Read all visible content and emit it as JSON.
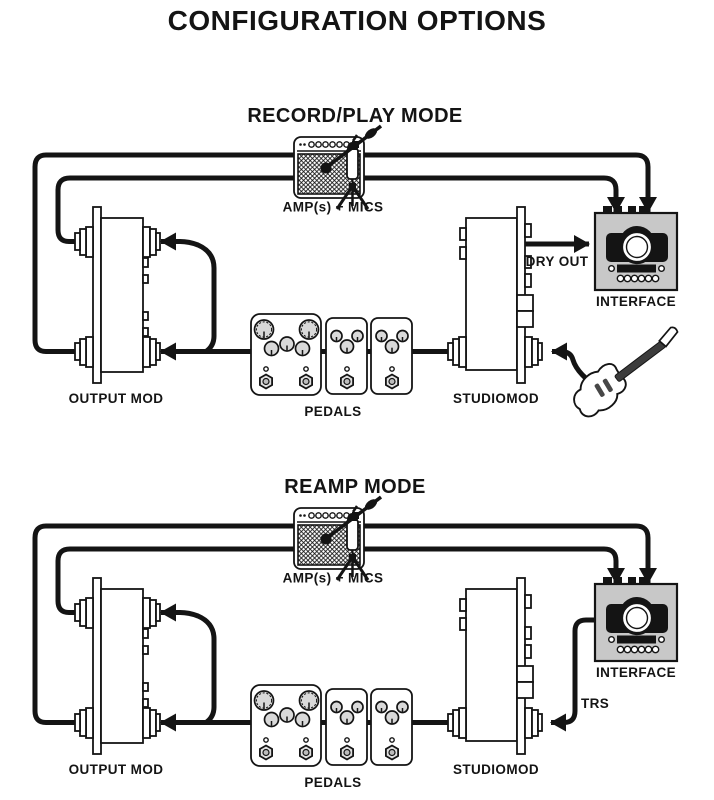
{
  "page_title": "CONFIGURATION OPTIONS",
  "colors": {
    "ink": "#141414",
    "interface_gray": "#c8c8c8",
    "knob_gray": "#d9d9d9",
    "background": "#ffffff"
  },
  "modes": [
    {
      "title": "RECORD/PLAY MODE",
      "amp_mics_label": "AMP(s) + MICS",
      "output_mod_label": "OUTPUT MOD",
      "pedals_label": "PEDALS",
      "studiomod_label": "STUDIOMOD",
      "interface_label": "INTERFACE",
      "dry_out_label": "DRY OUT"
    },
    {
      "title": "REAMP MODE",
      "amp_mics_label": "AMP(s) + MICS",
      "output_mod_label": "OUTPUT MOD",
      "pedals_label": "PEDALS",
      "studiomod_label": "STUDIOMOD",
      "interface_label": "INTERFACE",
      "trs_label": "TRS"
    }
  ]
}
